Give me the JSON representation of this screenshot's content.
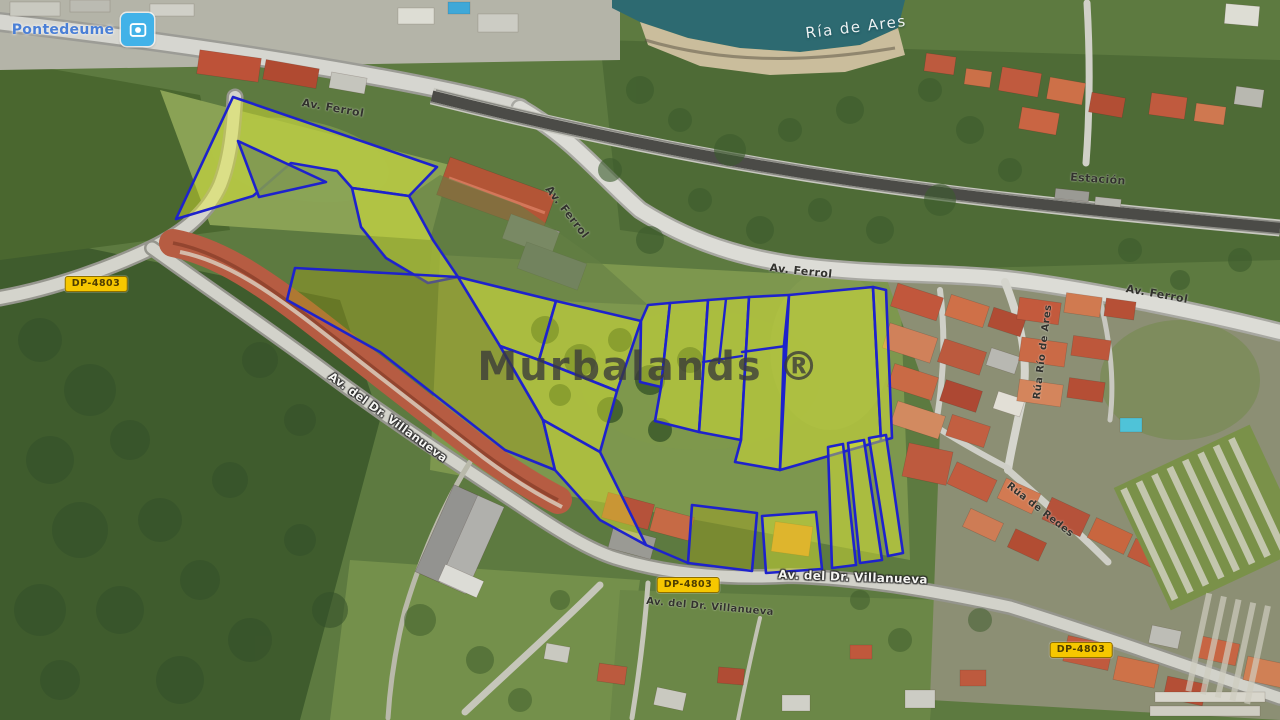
{
  "map": {
    "watermark": "Murbalands ®",
    "place": "Pontedeume",
    "water": "Ría de Ares",
    "roads": {
      "av_ferrol": "Av. Ferrol",
      "estacion": "Estación",
      "dp_4803": "DP-4803",
      "av_villanueva": "Av. del Dr. Villanueva",
      "rua_rio_de_ares": "Rúa Río de Ares",
      "rua_de_redes": "Rúa de Redes"
    },
    "colors": {
      "parcel_outline": "#1e22cc",
      "parcel_fill_bright": "rgba(228,236,48,0.44)",
      "parcel_fill_olive": "rgba(165,162,28,0.40)",
      "badge_bg": "#f6c700",
      "badge_border": "#8e6f00",
      "badge_text": "#4d3d00",
      "water": "#2d6a71",
      "watermark_color": "rgba(58,58,58,0.78)",
      "label_dark": "#32322d",
      "label_white": "#f5f5f2",
      "place_blue": "#4a7fd6"
    }
  }
}
